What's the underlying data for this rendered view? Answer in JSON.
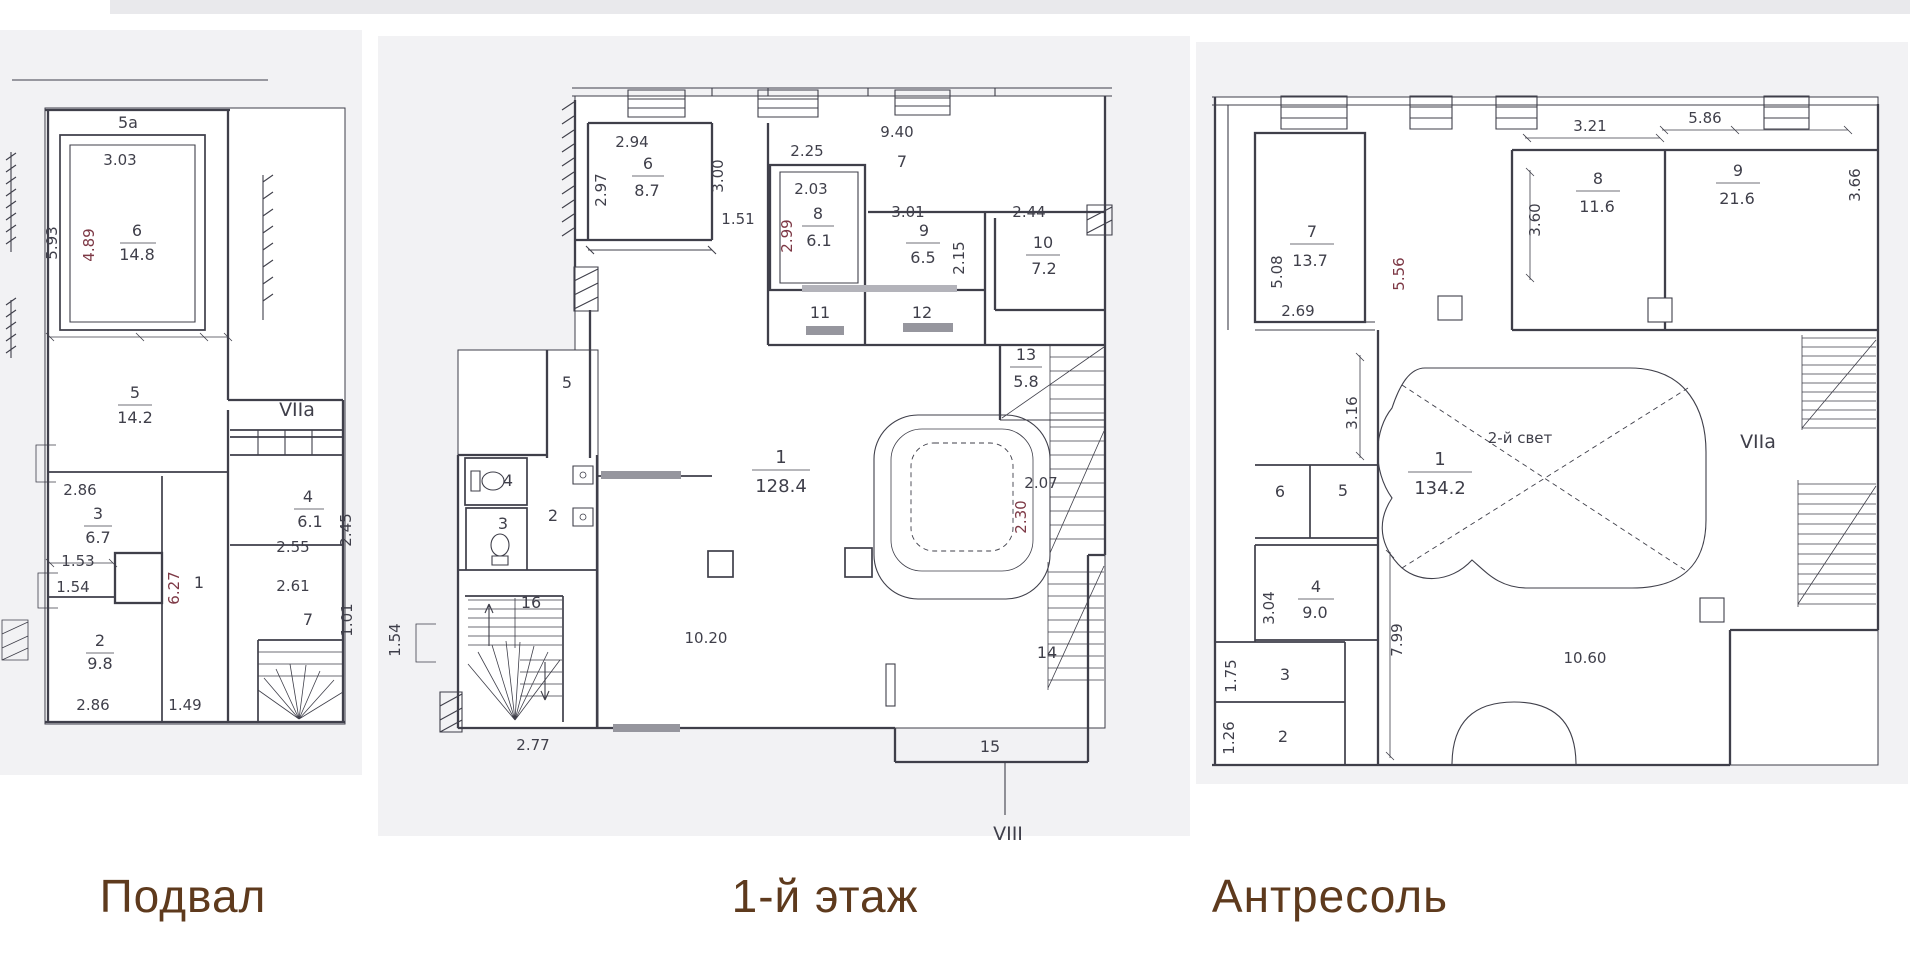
{
  "colors": {
    "ink": "#3f3f4a",
    "red": "#7d3845",
    "caption": "#5e3a1d",
    "paper": "#f2f2f4",
    "band": "#e9e9ec",
    "sill": "#96969e"
  },
  "captions": {
    "basement": "Подвал",
    "floor1": "1-й этаж",
    "mezzanine": "Антресоль"
  },
  "basement": {
    "rooms": {
      "r6": {
        "num": "6",
        "area": "14.8"
      },
      "r5": {
        "num": "5",
        "area": "14.2"
      },
      "r3": {
        "num": "3",
        "area": "6.7"
      },
      "r2": {
        "num": "2",
        "area": "9.8"
      },
      "r4": {
        "num": "4",
        "area": "6.1"
      }
    },
    "numbers": {
      "block": "5a",
      "corridor": "1",
      "room7": "7",
      "zone": "VIIa"
    },
    "dims": {
      "d303": "3.03",
      "d593": "5.93",
      "d489": "4.89",
      "d286a": "2.86",
      "d153": "1.53",
      "d154": "1.54",
      "d286b": "2.86",
      "d627": "6.27",
      "d149": "1.49",
      "d255": "2.55",
      "d245": "2.45",
      "d261": "2.61",
      "d101": "1.01"
    }
  },
  "floor1": {
    "rooms": {
      "r6": {
        "num": "6",
        "area": "8.7"
      },
      "r8": {
        "num": "8",
        "area": "6.1"
      },
      "r9": {
        "num": "9",
        "area": "6.5"
      },
      "r10": {
        "num": "10",
        "area": "7.2"
      },
      "r13": {
        "num": "13",
        "area": "5.8"
      },
      "r1": {
        "num": "1",
        "area": "128.4"
      }
    },
    "numbers": {
      "hall7": "7",
      "r11": "11",
      "r12": "12",
      "r14": "14",
      "r15": "15",
      "r16": "16",
      "r2": "2",
      "r3": "3",
      "r4": "4",
      "r5": "5",
      "section": "VIII"
    },
    "dims": {
      "d294": "2.94",
      "d297": "2.97",
      "d300": "3.00",
      "d151": "1.51",
      "d225": "2.25",
      "d203": "2.03",
      "d299": "2.99",
      "d940": "9.40",
      "d301": "3.01",
      "d215": "2.15",
      "d244": "2.44",
      "d207": "2.07",
      "d230": "2.30",
      "d1020": "10.20",
      "d277": "2.77",
      "d154": "1.54"
    }
  },
  "mezzanine": {
    "rooms": {
      "r7": {
        "num": "7",
        "area": "13.7"
      },
      "r8": {
        "num": "8",
        "area": "11.6"
      },
      "r9": {
        "num": "9",
        "area": "21.6"
      },
      "r1": {
        "num": "1",
        "area": "134.2"
      },
      "r4": {
        "num": "4",
        "area": "9.0"
      }
    },
    "numbers": {
      "r6": "6",
      "r5": "5",
      "r3": "3",
      "r2": "2",
      "zone": "VIIa",
      "light": "2-й свет"
    },
    "dims": {
      "d321": "3.21",
      "d360": "3.60",
      "d586": "5.86",
      "d366": "3.66",
      "d508": "5.08",
      "d556": "5.56",
      "d269": "2.69",
      "d316": "3.16",
      "d304": "3.04",
      "d799": "7.99",
      "d175": "1.75",
      "d126": "1.26",
      "d1060": "10.60"
    }
  }
}
